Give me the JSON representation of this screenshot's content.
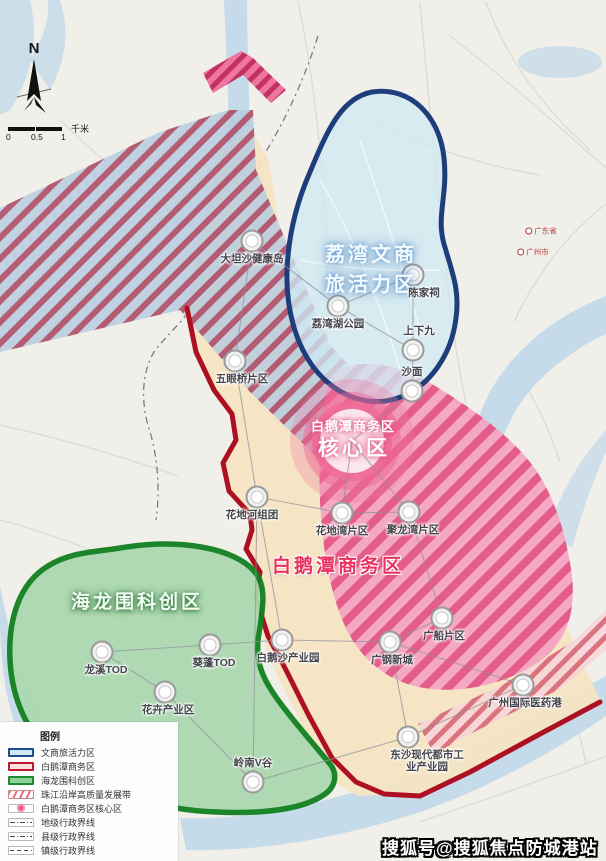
{
  "map": {
    "compass": {
      "label": "N"
    },
    "scalebar": {
      "tick0": "0",
      "tick1": "0.5",
      "tick2": "1",
      "unit": "千米"
    },
    "zones": {
      "liwan": {
        "line1": "荔湾文商",
        "line2": "旅活力区"
      },
      "core": {
        "line1": "白鹅潭商务区",
        "line2": "核心区"
      },
      "baietan": {
        "name": "白鹅潭商务区"
      },
      "hailong": {
        "name": "海龙围科创区"
      }
    },
    "nodes": [
      {
        "label": "大坦沙健康岛",
        "x": 252,
        "y": 241,
        "pos": "below"
      },
      {
        "label": "陈家祠",
        "x": 413,
        "y": 275,
        "pos": "below",
        "lx": 424
      },
      {
        "label": "荔湾湖公园",
        "x": 338,
        "y": 306,
        "pos": "below"
      },
      {
        "label": "上下九",
        "x": 413,
        "y": 350,
        "pos": "above",
        "lx": 419
      },
      {
        "label": "沙面",
        "x": 412,
        "y": 391,
        "pos": "above"
      },
      {
        "label": "五眼桥片区",
        "x": 235,
        "y": 361,
        "pos": "below",
        "lx": 242
      },
      {
        "label": "花地河组团",
        "x": 257,
        "y": 497,
        "pos": "below",
        "lx": 252
      },
      {
        "label": "花地湾片区",
        "x": 342,
        "y": 513,
        "pos": "below"
      },
      {
        "label": "聚龙湾片区",
        "x": 409,
        "y": 512,
        "pos": "below",
        "lx": 413
      },
      {
        "label": "龙溪TOD",
        "x": 102,
        "y": 652,
        "pos": "below",
        "lx": 106
      },
      {
        "label": "葵蓬TOD",
        "x": 210,
        "y": 645,
        "pos": "below",
        "lx": 214
      },
      {
        "label": "花卉产业区",
        "x": 165,
        "y": 692,
        "pos": "below",
        "lx": 168
      },
      {
        "label": "白鹅沙产业园",
        "x": 282,
        "y": 640,
        "pos": "below",
        "lx": 288
      },
      {
        "label": "广钢新城",
        "x": 390,
        "y": 642,
        "pos": "below",
        "lx": 392
      },
      {
        "label": "广船片区",
        "x": 442,
        "y": 618,
        "pos": "below",
        "lx": 444
      },
      {
        "label": "广州国际医药港",
        "x": 523,
        "y": 685,
        "pos": "below",
        "lx": 525
      },
      {
        "label": "东沙现代都市工\n业产业园",
        "x": 408,
        "y": 737,
        "pos": "below",
        "lx": 427
      },
      {
        "label": "岭南V谷",
        "x": 253,
        "y": 782,
        "pos": "above"
      }
    ],
    "edges": [
      [
        0,
        2
      ],
      [
        2,
        1
      ],
      [
        1,
        3
      ],
      [
        2,
        3
      ],
      [
        3,
        4
      ],
      [
        0,
        5
      ],
      [
        5,
        6
      ],
      [
        6,
        7
      ],
      [
        7,
        8
      ],
      [
        6,
        12
      ],
      [
        6,
        17
      ],
      [
        9,
        10
      ],
      [
        9,
        11
      ],
      [
        10,
        12
      ],
      [
        11,
        17
      ],
      [
        12,
        13
      ],
      [
        13,
        14
      ],
      [
        8,
        14
      ],
      [
        13,
        15
      ],
      [
        13,
        16
      ],
      [
        15,
        16
      ],
      [
        16,
        17
      ]
    ],
    "core_links": [
      4,
      7,
      8
    ],
    "basemap_labels": [
      {
        "text": "广东省",
        "x": 541,
        "y": 231
      },
      {
        "text": "广州市",
        "x": 533,
        "y": 252
      }
    ],
    "legend": {
      "title": "图例",
      "items": [
        {
          "type": "area",
          "label": "文商旅活力区",
          "fill": "#d3e6f3",
          "border": "#1d4e89"
        },
        {
          "type": "area",
          "label": "白鹅潭商务区",
          "fill": "#f9e3da",
          "border": "#c0182c"
        },
        {
          "type": "area",
          "label": "海龙围科创区",
          "fill": "#8fd19b",
          "border": "#1c8a2f"
        },
        {
          "type": "hatch",
          "label": "珠江沿岸高质量发展带"
        },
        {
          "type": "core",
          "label": "白鹅潭商务区核心区"
        },
        {
          "type": "dashdot",
          "label": "地级行政界线"
        },
        {
          "type": "dashdot",
          "label": "县级行政界线"
        },
        {
          "type": "dashed",
          "label": "镇级行政界线"
        }
      ]
    },
    "watermark": "搜狐号@搜狐焦点防城港站",
    "colors": {
      "business_border": "#ad1022",
      "science_border": "#11801f",
      "vitality_border": "#1e3e7b",
      "core_pink": "#e9557f",
      "river": "#c6dbe9"
    }
  }
}
